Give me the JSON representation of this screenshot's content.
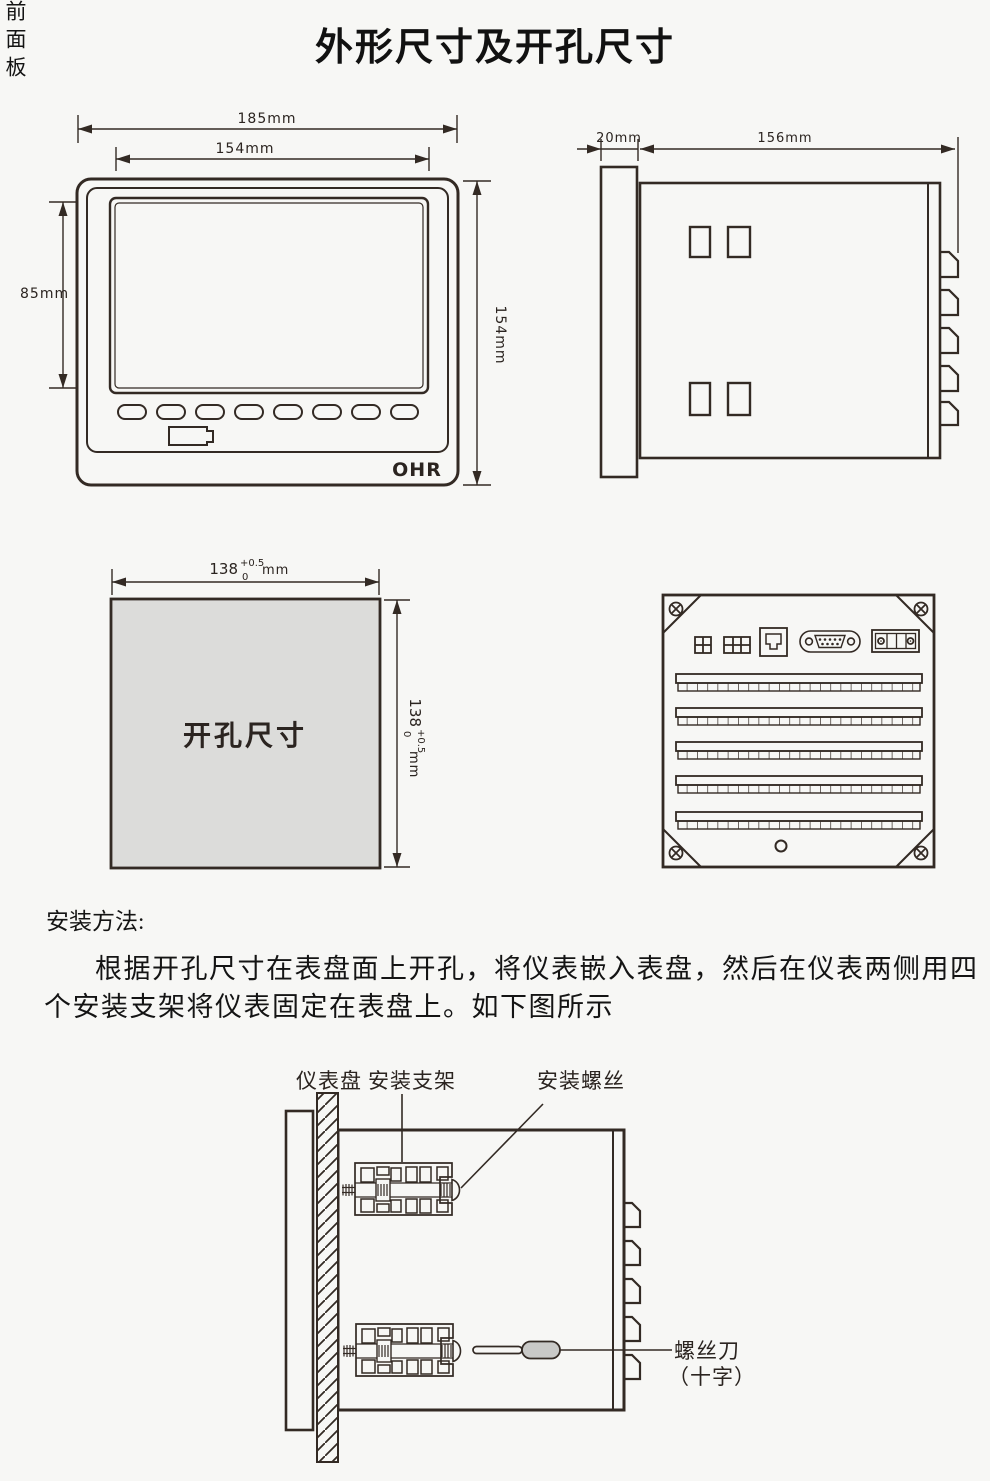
{
  "title": "外形尺寸及开孔尺寸",
  "colors": {
    "line": "#332a24",
    "background": "#f7f7f5",
    "cutout_fill": "#dcdcda",
    "screwdriver_handle_fill": "#c9c9c7"
  },
  "front_view": {
    "dim_width_outer": "185mm",
    "dim_width_screen": "154mm",
    "dim_height_screen": "85mm",
    "dim_height_outer": "154mm",
    "logo": "OHR"
  },
  "side_view": {
    "dim_depth_bezel": "20mm",
    "dim_depth_body": "156mm"
  },
  "cutout_view": {
    "label": "开孔尺寸",
    "width": {
      "value": "138",
      "tol_upper": "+0.5",
      "tol_lower": "0",
      "unit": "mm"
    },
    "height": {
      "value": "138",
      "tol_upper": "+0.5",
      "tol_lower": "0",
      "unit": "mm"
    }
  },
  "install_text": {
    "heading": "安装方法:",
    "line1": "根据开孔尺寸在表盘面上开孔，将仪表嵌入表盘，然后在仪表两侧用四",
    "line2": "个安装支架将仪表固定在表盘上。如下图所示"
  },
  "install_diagram": {
    "label_panel": "仪表盘",
    "label_bracket": "安装支架",
    "label_screw": "安装螺丝",
    "label_front_panel": "前面板",
    "label_screwdriver": "螺丝刀",
    "label_screwdriver_type": "（十字）"
  }
}
